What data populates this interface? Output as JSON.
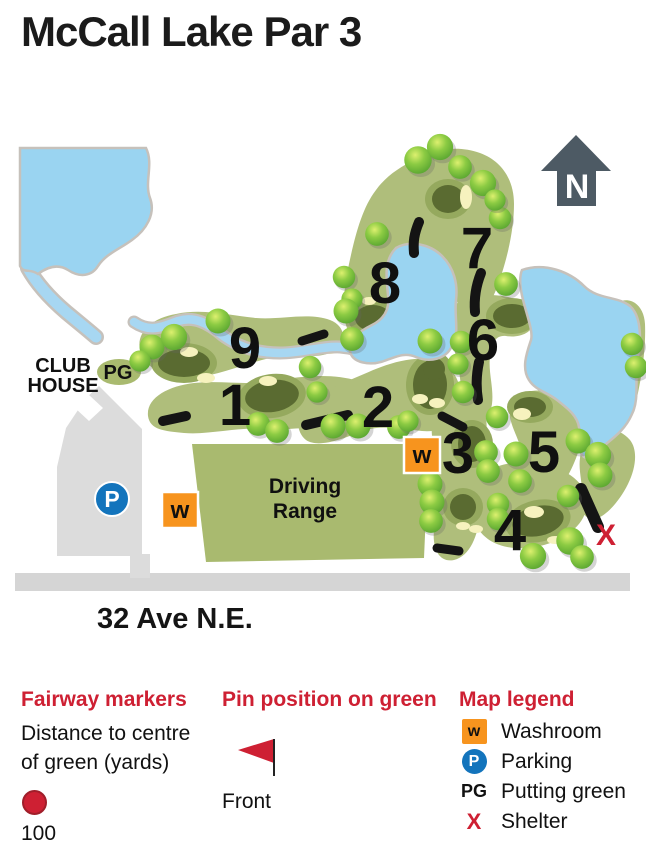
{
  "title": "McCall Lake Par 3",
  "map": {
    "north_label": "N",
    "club_house_line1": "CLUB",
    "club_house_line2": "HOUSE",
    "putting_green_abbr": "PG",
    "driving_range_line1": "Driving",
    "driving_range_line2": "Range",
    "parking_abbr": "P",
    "washroom_abbr": "w",
    "shelter_abbr": "X",
    "road_label": "32 Ave N.E.",
    "holes": [
      "1",
      "2",
      "3",
      "4",
      "5",
      "6",
      "7",
      "8",
      "9"
    ]
  },
  "legend": {
    "fairway": {
      "title": "Fairway markers",
      "desc_line1": "Distance to centre",
      "desc_line2": "of green (yards)",
      "marker_value": "100"
    },
    "pin": {
      "title": "Pin position on green",
      "flag_label": "Front"
    },
    "map_legend": {
      "title": "Map legend",
      "items": [
        {
          "symbol": "w",
          "label": "Washroom"
        },
        {
          "symbol": "P",
          "label": "Parking"
        },
        {
          "symbol": "PG",
          "label": "Putting green"
        },
        {
          "symbol": "X",
          "label": "Shelter"
        }
      ]
    }
  },
  "colors": {
    "accent_red": "#CE2033",
    "marker_orange": "#F7941E",
    "parking_blue": "#1374BC",
    "fairway_green": "#AFBE7B",
    "putting_green_dark": "#5A6B31",
    "lake_blue": "#9AD4F1",
    "road_gray": "#D5D5D5",
    "north_arrow_gray": "#4D5A64"
  }
}
